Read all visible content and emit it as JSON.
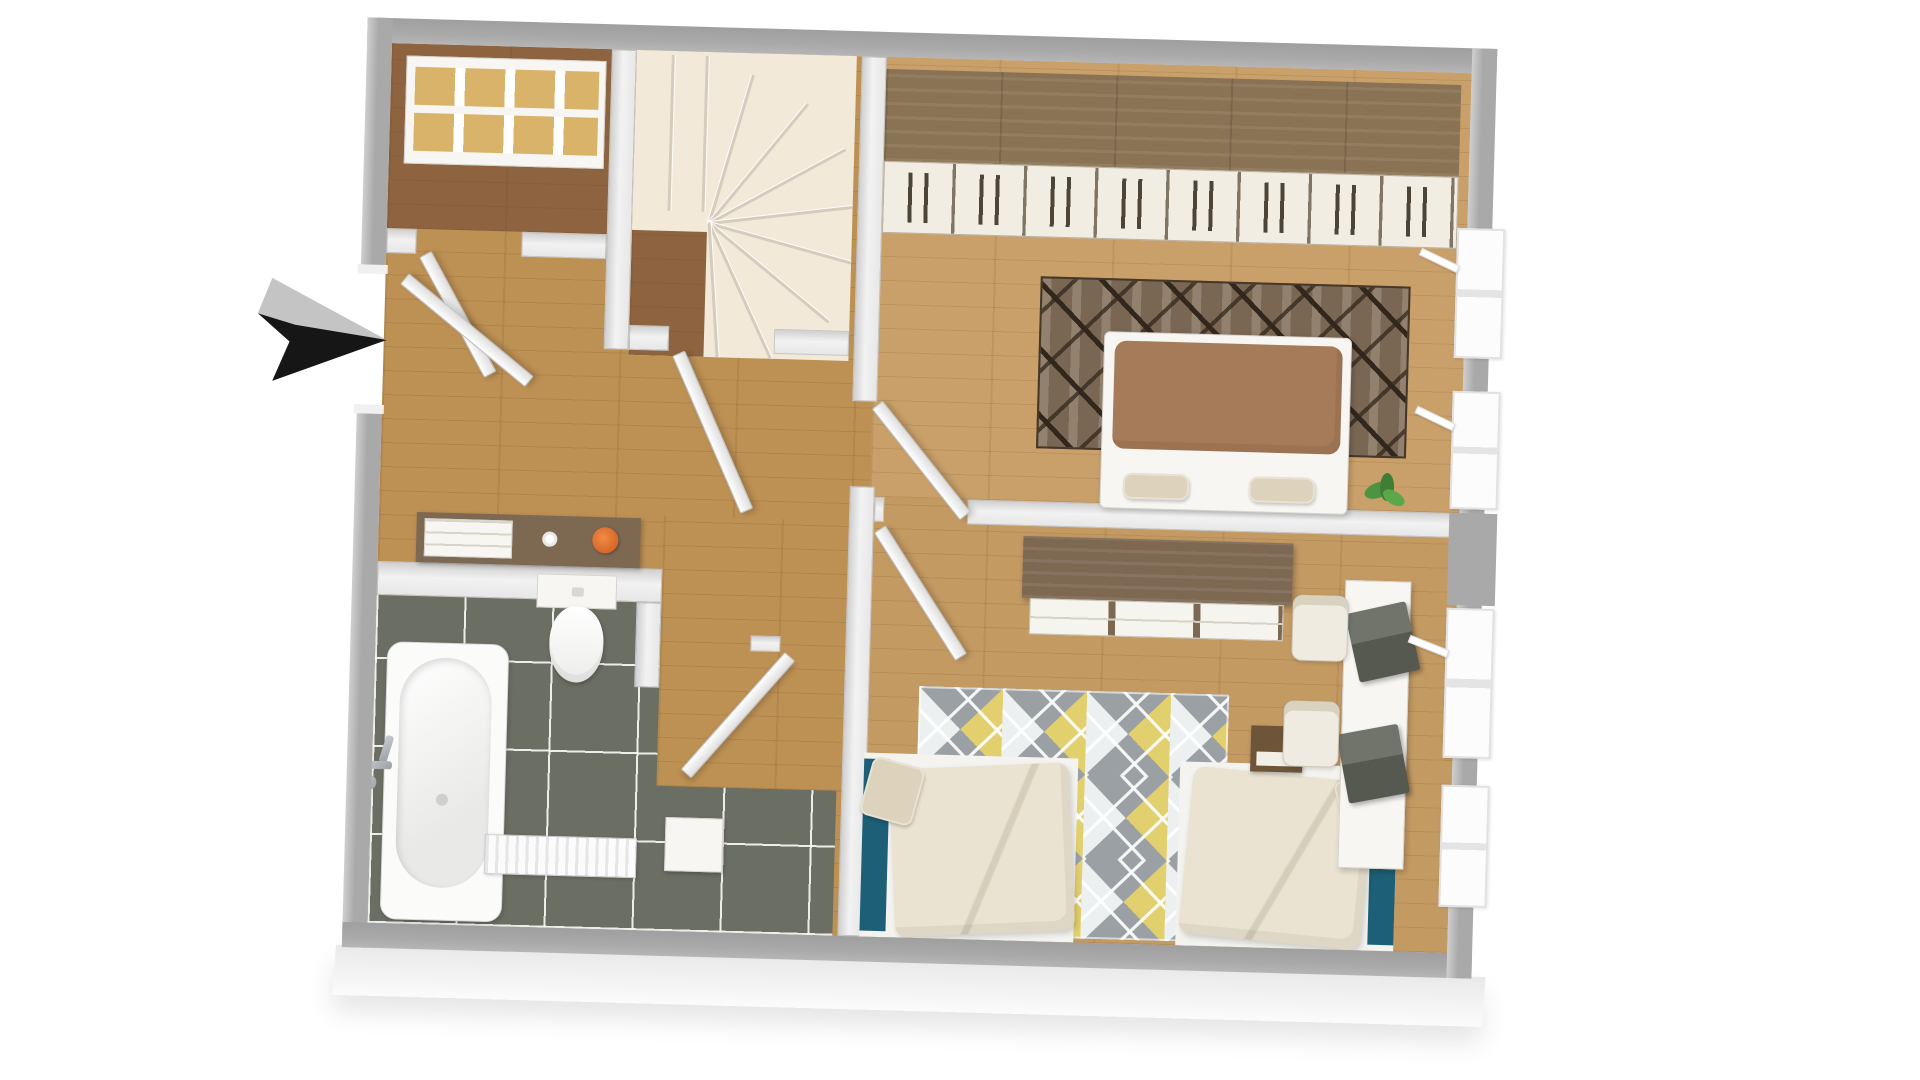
{
  "canvas": {
    "width": 1920,
    "height": 1080
  },
  "colors": {
    "page_bg": "#ffffff",
    "wall_exterior": "#a9a9a9",
    "wall_interior": "#f2f2f2",
    "wall_interior_edge": "#c6c6c6",
    "wood_hall": "#bd9054",
    "wood_room": "#c9a06a",
    "wood_kids": "#c49a63",
    "wood_dark": "#8d6340",
    "stair_tread": "#f3e9d8",
    "stair_line": "#d6ccbd",
    "tile_floor": "#6a6e63",
    "rug_dark_base": "#7a6753",
    "rug_dark_line": "#32271c",
    "rug_yellow": "#e2cf6e",
    "rug_gray": "#9aa0a3",
    "rug_white": "#edf0f0",
    "duvet_brown": "#a57b59",
    "duvet_cream": "#eae3d1",
    "teal_accent": "#1d5f76",
    "pillow_beige": "#ddd3bc",
    "wardrobe_wood": "#8a7355",
    "wardrobe_door": "#f1ede3",
    "wardrobe_handle": "#4c4437",
    "sideboard_wood": "#7d6852",
    "box_tan": "#d9b36a",
    "plant_green": "#4c9440",
    "pot_orange": "#d96a2a",
    "laptop_gray": "#55594f",
    "chrome": "#9aa0a6",
    "window_frame": "#e2e2e2",
    "arrow_dark": "#161616",
    "arrow_gray": "#c4c4c4"
  },
  "scene": {
    "type": "3d-floor-plan-top-view",
    "entrance_arrow": "points-right-toward-entry",
    "rooms": [
      {
        "name": "built-in-closet",
        "furniture": [
          "shelving-unit-with-tan-storage-boxes",
          "closet-door"
        ]
      },
      {
        "name": "staircase",
        "furniture": [
          "winder-spiral-stairs"
        ]
      },
      {
        "name": "hallway",
        "furniture": [
          "entrance-door",
          "console-with-drawers",
          "orange-plant-pot",
          "paper-roll",
          "open-doors"
        ]
      },
      {
        "name": "bedroom",
        "furniture": [
          "wardrobe-row",
          "dark-pattern-rug",
          "double-bed-brown-duvet",
          "foot-pillows",
          "green-plant",
          "two-windows"
        ]
      },
      {
        "name": "bathroom",
        "furniture": [
          "bathtub",
          "faucet",
          "wall-hung-toilet",
          "radiator",
          "small-cabinet",
          "door"
        ]
      },
      {
        "name": "second-bedroom",
        "furniture": [
          "sideboard",
          "diamond-pattern-rug",
          "two-single-beds",
          "desk",
          "two-chairs",
          "two-laptops",
          "nightstand",
          "two-windows"
        ]
      }
    ],
    "counts": {
      "wardrobe_doors": 8,
      "stair_fan_treads": 8,
      "windows_right_wall": 4
    }
  }
}
